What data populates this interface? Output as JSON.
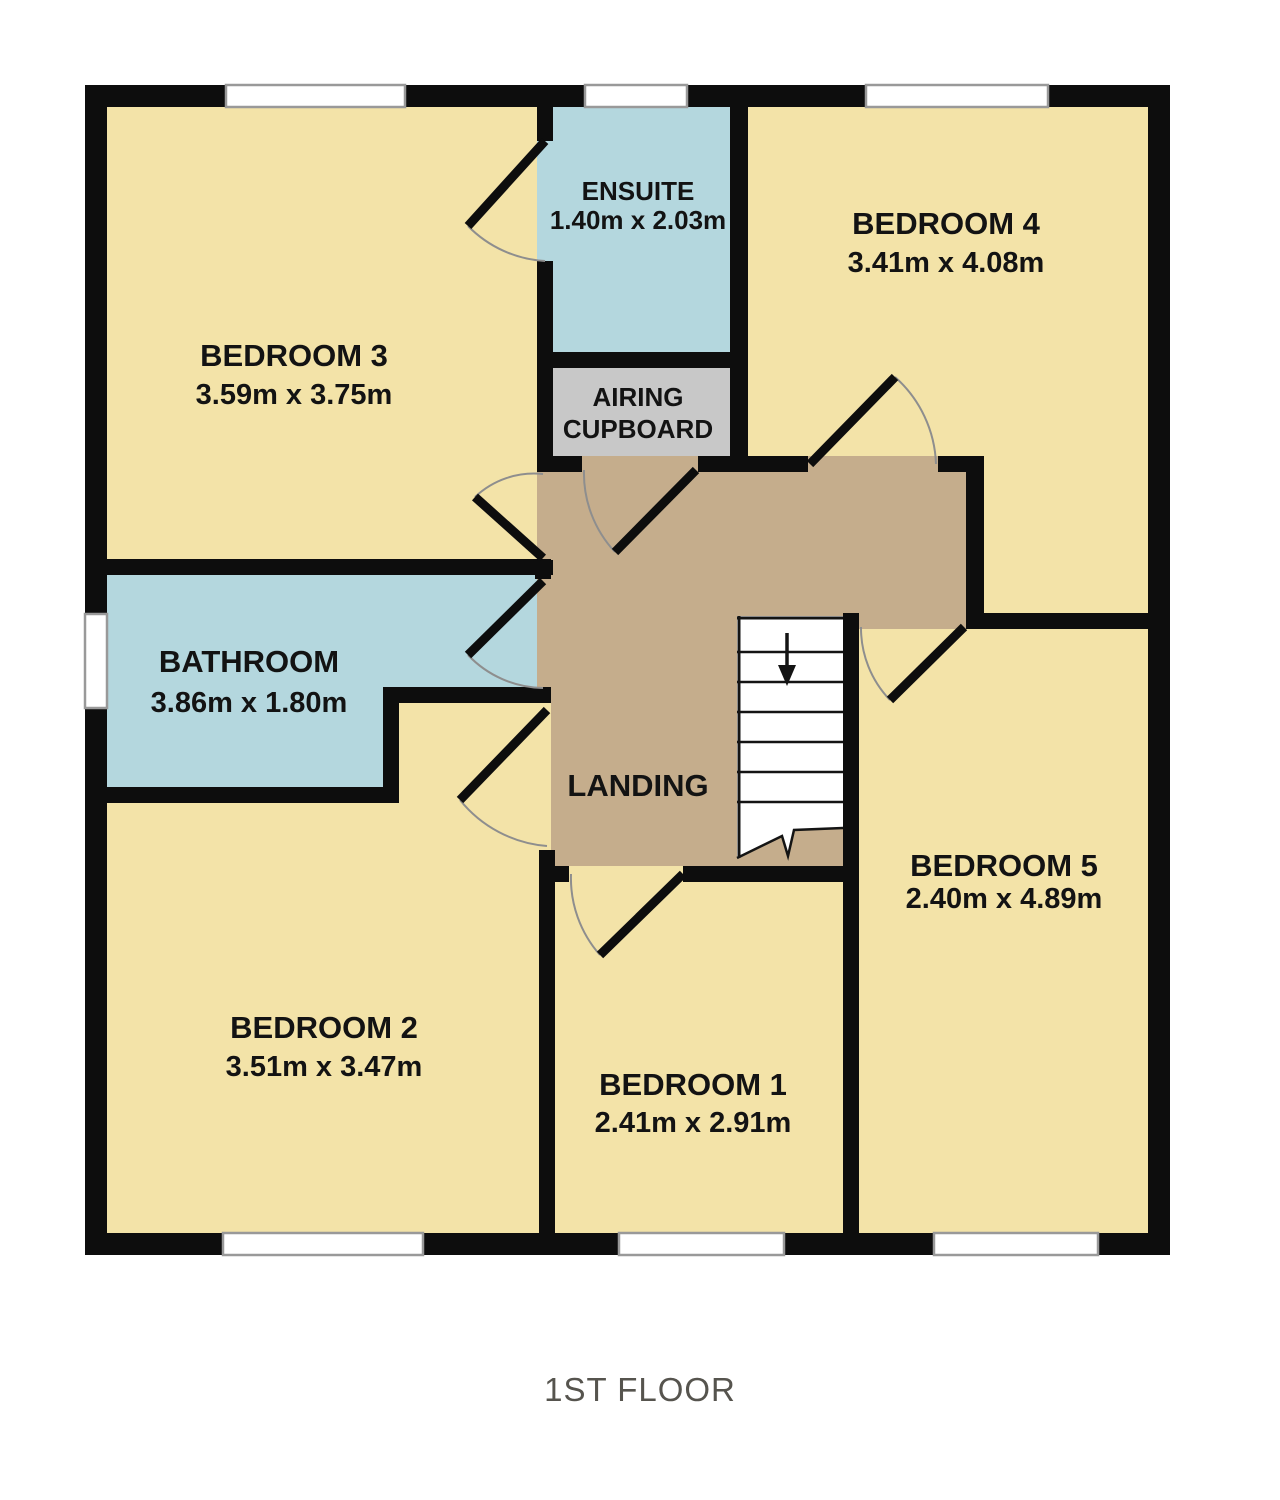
{
  "floor_title": "1ST FLOOR",
  "colors": {
    "wall": "#0d0d0d",
    "bedroom_fill": "#f3e3a8",
    "wet_room_fill": "#b4d7de",
    "landing_fill": "#c5ad8c",
    "cupboard_fill": "#c8c8c8",
    "window_fill": "#ffffff",
    "window_outline": "#999999",
    "door_arc": "#8e8e8e",
    "label_color": "#131313",
    "title_color": "#56544e"
  },
  "rooms": {
    "bedroom3": {
      "name": "BEDROOM 3",
      "dims": "3.59m x 3.75m"
    },
    "ensuite": {
      "name": "ENSUITE",
      "dims": "1.40m x 2.03m"
    },
    "bedroom4": {
      "name": "BEDROOM 4",
      "dims": "3.41m x 4.08m"
    },
    "airing_cupboard": {
      "line1": "AIRING",
      "line2": "CUPBOARD"
    },
    "bathroom": {
      "name": "BATHROOM",
      "dims": "3.86m x 1.80m"
    },
    "landing": {
      "name": "LANDING"
    },
    "bedroom2": {
      "name": "BEDROOM 2",
      "dims": "3.51m x 3.47m"
    },
    "bedroom1": {
      "name": "BEDROOM 1",
      "dims": "2.41m x 2.91m"
    },
    "bedroom5": {
      "name": "BEDROOM 5",
      "dims": "2.40m x 4.89m"
    }
  }
}
